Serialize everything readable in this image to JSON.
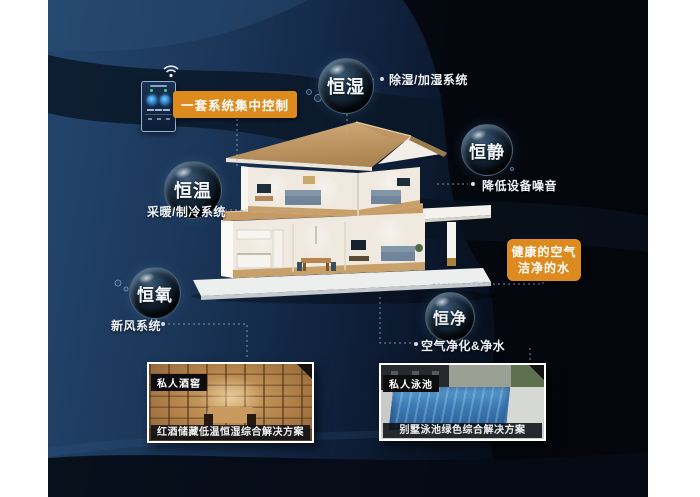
{
  "poster": {
    "accent_orange": "#dd8a1f",
    "background_navy": "#1a3557",
    "control_label": "一套系统集中控制",
    "callout": {
      "line1": "健康的空气",
      "line2": "洁净的水"
    },
    "bubbles": [
      {
        "title": "恒湿",
        "note": "除湿/加湿系统"
      },
      {
        "title": "恒静",
        "note": "降低设备噪音"
      },
      {
        "title": "恒温",
        "note": "采暖/制冷系统"
      },
      {
        "title": "恒氧",
        "note": "新风系统"
      },
      {
        "title": "恒净",
        "note": "空气净化&净水"
      }
    ],
    "photos": [
      {
        "tag": "私人酒窖",
        "caption": "红酒储藏低温恒湿综合解决方案"
      },
      {
        "tag": "私人泳池",
        "caption": "别墅泳池绿色综合解决方案"
      }
    ]
  }
}
